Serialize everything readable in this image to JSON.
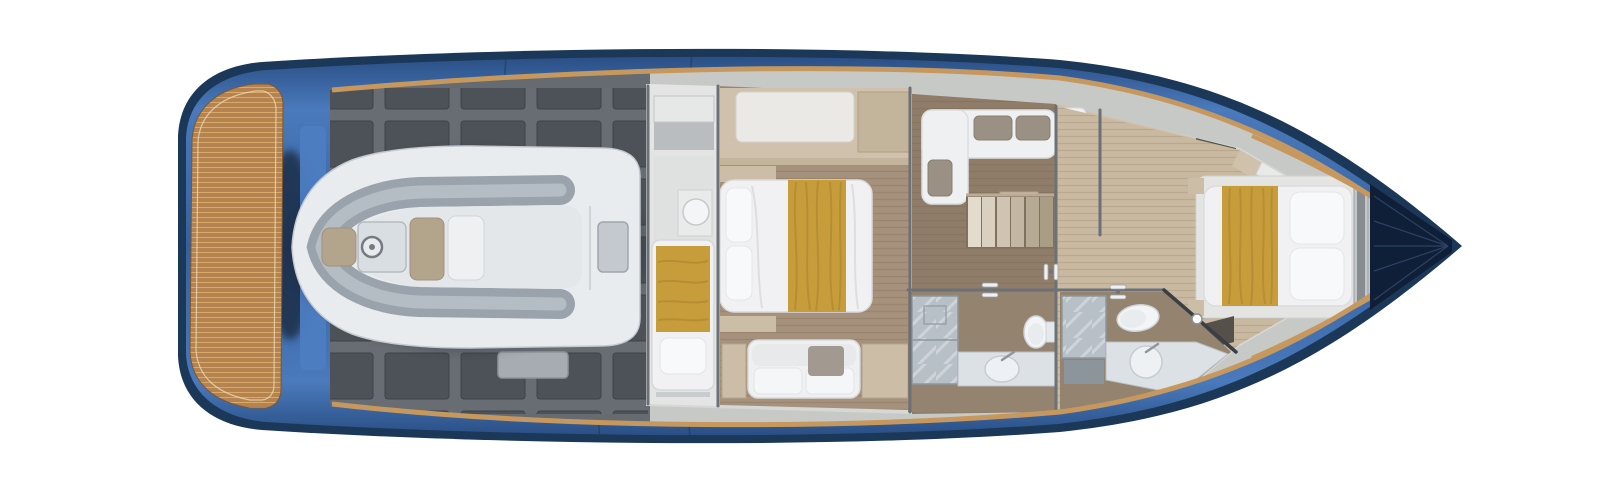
{
  "scene": {
    "subject": "motor-yacht-lower-deck-floor-plan",
    "view": "top-down-3d-render",
    "orientation": "bow-right-stern-left",
    "background": "#ffffff"
  },
  "rooms": [
    {
      "id": "swim-platform",
      "kind": "teak-swim-platform"
    },
    {
      "id": "aft-deck",
      "kind": "engine-hatch-deck"
    },
    {
      "id": "tender",
      "kind": "rib-dinghy-stowed"
    },
    {
      "id": "crew-cabin",
      "kind": "single-berth-with-sink"
    },
    {
      "id": "master-cabin",
      "kind": "double-bed-with-sofa"
    },
    {
      "id": "lounge-stairs",
      "kind": "l-sofa-and-companionway-stairs"
    },
    {
      "id": "master-bathroom",
      "kind": "shower-toilet-vanity"
    },
    {
      "id": "vip-bathroom",
      "kind": "shower-toilet-vanity-glass-corner"
    },
    {
      "id": "vip-cabin",
      "kind": "double-bed-bow"
    },
    {
      "id": "anchor-locker",
      "kind": "bow-locker"
    }
  ],
  "colors": {
    "background": "#ffffff",
    "hull_navy": "#1c3859",
    "hull_blue": "#3c6bac",
    "hull_blue_panel": "#4d7dc1",
    "hull_step_blue": "#7fa6dc",
    "rub_rail_tan": "#c6985e",
    "teak": "#b5834f",
    "teak_line": "#d9a968",
    "deck_gray": "#656b71",
    "deck_panel": "#4c5257",
    "walkway_gray": "#c7c9c7",
    "cabin_wall_light": "#d6d8d6",
    "wall_gray": "#6b7176",
    "floor_master": "#a5917c",
    "floor_corridor": "#8f7d6a",
    "floor_bow": "#c9b9a1",
    "bathroom_floor": "#94836f",
    "wood_cabinet": "#cfc1ab",
    "wood_cabinet_dark": "#c3b49c",
    "bedding_white": "#f1f1f3",
    "pillow_white": "#f8f9fa",
    "blanket_gold": "#c79d3c",
    "blanket_gold_dark": "#a8832c",
    "sofa_white": "#eff0f2",
    "pillow_taupe": "#9a9083",
    "throw_gray": "#a29a90",
    "marble_shower": "#b7bfc7",
    "vanity_marble": "#dce1e5",
    "porcelain": "#f3f4f6",
    "tender_hull": "#e9ecef",
    "tender_tube": "#9aa3ab",
    "tender_deck": "#e3e7ea",
    "tender_cushion": "#b3a48c",
    "console_gray": "#d9dee2",
    "anchor_navy": "#101f38",
    "closet_dark": "#55514a",
    "chrome": "#eef0f2"
  }
}
